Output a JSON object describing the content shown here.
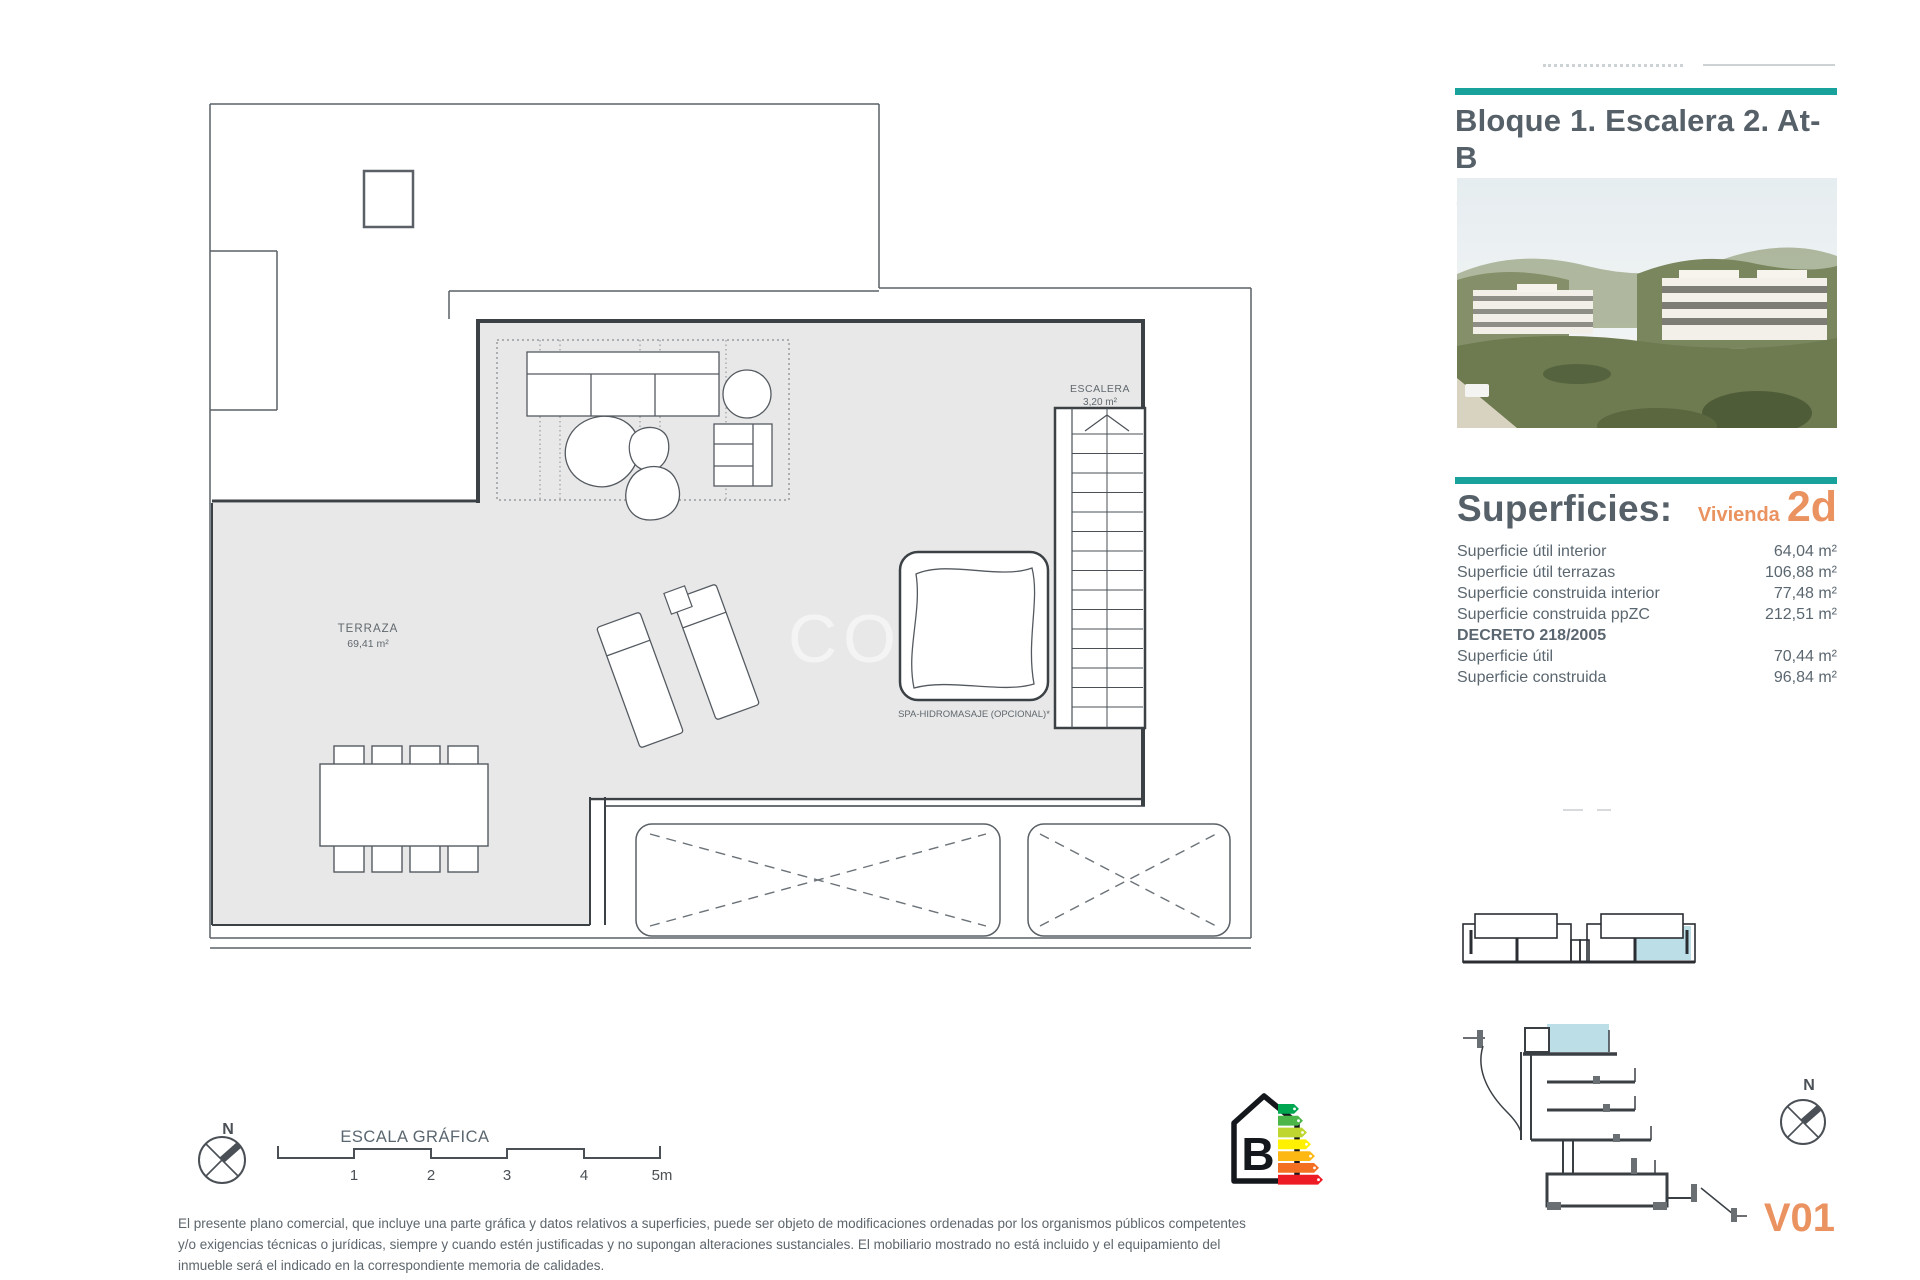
{
  "colors": {
    "accent_teal": "#18A29B",
    "accent_orange": "#EA9260",
    "title_gray": "#566068",
    "plan_fill": "#E8E8E8",
    "highlight_blue": "#BCDFE7"
  },
  "header": {
    "title_line1": "Bloque 1. Escalera 2. At-B",
    "title_line2": "1-2-At-B"
  },
  "superficies": {
    "title": "Superficies:",
    "vivienda_label": "Vivienda",
    "vivienda_code": "2d",
    "rows": [
      {
        "label": "Superficie útil interior",
        "value": "64,04 m²"
      },
      {
        "label": "Superficie útil terrazas",
        "value": "106,88 m²"
      },
      {
        "label": "Superficie construida interior",
        "value": "77,48 m²"
      },
      {
        "label": "Superficie construida ppZC",
        "value": "212,51 m²"
      }
    ],
    "decreto_title": "DECRETO 218/2005",
    "decreto_rows": [
      {
        "label": "Superficie útil",
        "value": "70,44 m²"
      },
      {
        "label": "Superficie construida",
        "value": "96,84 m²"
      }
    ]
  },
  "plan": {
    "terraza_label": "TERRAZA",
    "terraza_area": "69,41 m²",
    "escalera_label": "ESCALERA",
    "escalera_area": "3,20 m²",
    "spa_label": "SPA-HIDROMASAJE (OPCIONAL)*",
    "watermark": "CO"
  },
  "scale_bar": {
    "title": "ESCALA GRÁFICA",
    "ticks": [
      "1",
      "2",
      "3",
      "4",
      "5m"
    ]
  },
  "compass": {
    "north_label": "N"
  },
  "energy": {
    "rating_letter": "B",
    "bar_colors": [
      "#00A650",
      "#4CB648",
      "#BED62F",
      "#FFF101",
      "#FDB813",
      "#F36F21",
      "#ED1B24"
    ]
  },
  "footer": {
    "disclaimer": "El presente plano comercial, que incluye una parte gráfica y datos relativos a superficies, puede ser objeto de modificaciones ordenadas por los organismos públicos competentes y/o exigencias técnicas o jurídicas, siempre y cuando estén justificadas y no supongan alteraciones sustanciales. El mobiliario mostrado no está incluido y el equipamiento del inmueble será el indicado en la correspondiente memoria de calidades."
  },
  "version_label": "V01"
}
